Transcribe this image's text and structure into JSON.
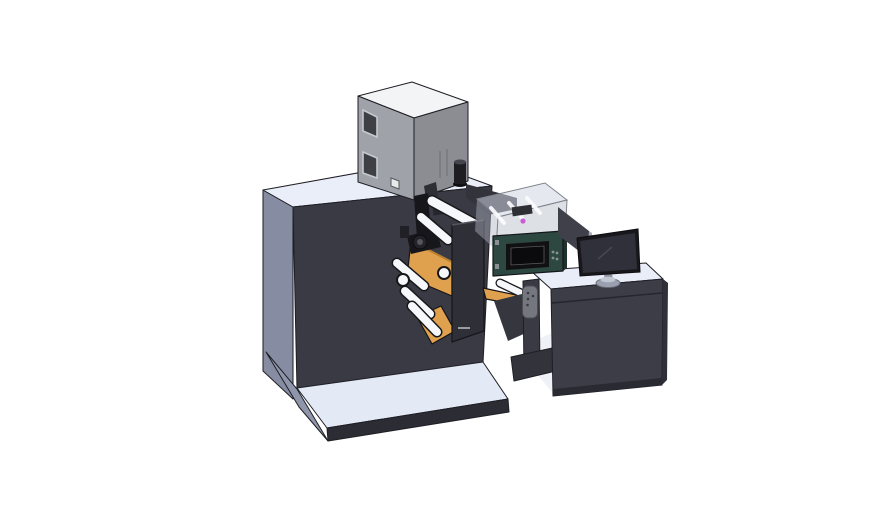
{
  "scene": {
    "type": "3d-cad-render",
    "description": "Isometric CAD rendering of a compact label printing press: feeder cabinet on top of the dark press body, web rollers with orange guide plates, a print-head assembly, a glazed inspection enclosure over a teal control unit, and an operator desk with a monitor on a light base platform.",
    "background": "#ffffff"
  },
  "components": [
    "press-body",
    "feeder-cabinet",
    "exhaust-cylinder",
    "base-platform",
    "printhead-assembly",
    "web-rollers",
    "orange-web-guides",
    "mount-plate",
    "inspection-enclosure",
    "control-unit",
    "output-chute",
    "operator-desk",
    "monitor",
    "monitor-stand",
    "rear-display-panel",
    "pendant-remote",
    "desk-foot"
  ],
  "colors": {
    "background": "#ffffff",
    "machine_front": "#3a3a44",
    "machine_side": "#868da3",
    "machine_top": "#eaeef9",
    "machine_back_wall": "#33333c",
    "platform_top": "#e4e9f6",
    "platform_rim": "#2c2c35",
    "platform_side": "#8f96ab",
    "cabinet_top": "#f3f4f6",
    "cabinet_left": "#9fa3a9",
    "cabinet_front": "#8b8d93",
    "window_glass": "#3e4046",
    "window_frame": "#c6c9cd",
    "hatch_square": "#e8e9eb",
    "cylinder_black": "#1d1d22",
    "cylinder_top": "#45454d",
    "cylinder_base": "#0e0e12",
    "roller_white": "#f5f7fa",
    "roller_outline": "#17171b",
    "web_orange": "#dfa14e",
    "web_orange_dark": "#b97f2e",
    "printhead_black": "#17171b",
    "printhead_gray": "#2e2e35",
    "mount_plate": "#2f2f38",
    "plate_highlight": "#55555e",
    "chute_dark": "#36363f",
    "enclosure_glass_top": "rgba(208,213,224,0.55)",
    "enclosure_glass_front": "rgba(188,193,204,0.50)",
    "enclosure_glass_side": "rgba(175,180,192,0.45)",
    "rail_white": "#fdfdfe",
    "inner_component": "#2e2e35",
    "accent_magenta": "#c95fd6",
    "control_teal": "#2c4841",
    "control_teal_side": "#1f332d",
    "control_bezel": "#111114",
    "control_screen": "#0b0b0d",
    "control_button": "#8a8f96",
    "desk_front": "#3d3d47",
    "desk_side": "#30303a",
    "desk_top": "#e9edf8",
    "desk_inner": "#eef1f8",
    "desk_leg": "#3a3a44",
    "desk_foot": "#33333c",
    "desk_base_strip": "#2a2a32",
    "remote_gray": "#75777e",
    "remote_dot": "#3a3a40",
    "panel_back": "#40404a",
    "panel_edge": "#a8adb8",
    "monitor_frame": "#17171c",
    "monitor_screen": "#30303a",
    "monitor_glint": "#474752",
    "stand_neck": "#8f94a2",
    "stand_base": "#9aa0af",
    "stand_base_top": "#c2c7d4",
    "edge_dark": "#1e1e24"
  }
}
